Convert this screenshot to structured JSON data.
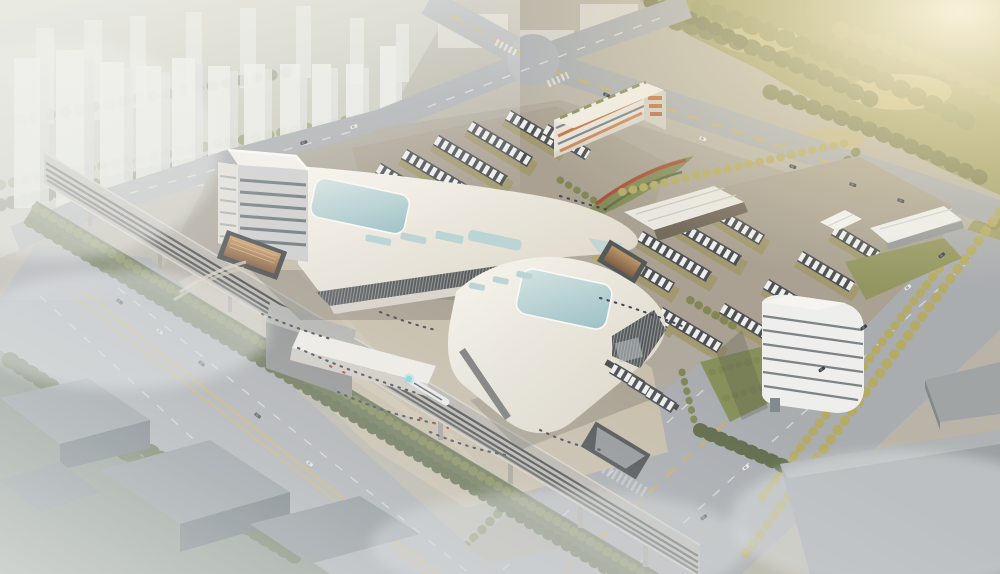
{
  "scene": {
    "type": "architectural aerial rendering",
    "description": "Bird's-eye 3D rendering of a large intermodal transit hub at golden hour: two sculptural white terminal buildings with teal glass skylights, an elevated railway viaduct with a train, bus depots full of coaches, a multi-storey parking garage with orange louvers, landscaped plazas with crowds, wide arterial roads, hazy residential towers to the northwest, a sunlit forest to the northeast, and fog-veiled industrial sheds in the foreground.",
    "time_of_day": "hazy golden-hour daylight, sun glare from upper right",
    "labels": {
      "city_towers": "hazy high-rise residential towers",
      "forest": "sunlit forest belt",
      "intersection": "road intersection",
      "arterial_road": "wide arterial road with yellow lane lines",
      "highway": "diagonal highway with traffic",
      "viaduct": "elevated railway viaduct on piers",
      "train": "white train with teal nose",
      "north_terminal": "main terminal hall with teal roof skylight",
      "terminal_tower": "terminal office tower block",
      "south_terminal": "south terminal hall with teal roof skylight",
      "plaza": "pedestrian plaza with crowds",
      "sunken_plaza": "sunken entrance courtyard",
      "upper_bus_lot": "bus parking apron",
      "bus_depot": "coach depot with parking strips",
      "parking_garage": "multi-storey garage with orange louvers",
      "office_building": "curved office building",
      "canopies": "depot canopies and shelters",
      "flower_berms": "landscaped berms with red flower stripes",
      "industrial": "fog-covered industrial sheds",
      "warehouses": "grey warehouse blocks in haze"
    }
  },
  "palette": {
    "ground_base": "#b5b1a4",
    "city_ground": "#c7c9bb",
    "forest_olive": "#9b9a60",
    "road_gray": "#a4a9ae",
    "site_gray": "#aba59a",
    "plaza_sand": "#c6bca8",
    "lot_gray": "#a59d8e",
    "roof_white": "#f2efe8",
    "facade_glass": "#4b5053",
    "glass_teal": "#b7d3d6",
    "lane_yellow": "#d2ab4a",
    "lane_white": "#e9ebec",
    "tree_dark": "#55633f",
    "tree_mid": "#79824d",
    "tree_warm": "#b1a75e",
    "bus_dark": "#41464b",
    "bus_white": "#eef0ef",
    "khaki_strip": "#9c9365",
    "people": "#3a3f49",
    "people_red": "#a8382e",
    "pier_gray": "#9f9c91",
    "rail_dark": "#3c4043",
    "floor_band": "#5e686d",
    "orange_accent": "#c06a33",
    "pit_amber": "#c2915f",
    "train_teal": "#7fd8dc",
    "fog_white": "#e3e7e8",
    "glow_warm": "#fdf4da"
  }
}
